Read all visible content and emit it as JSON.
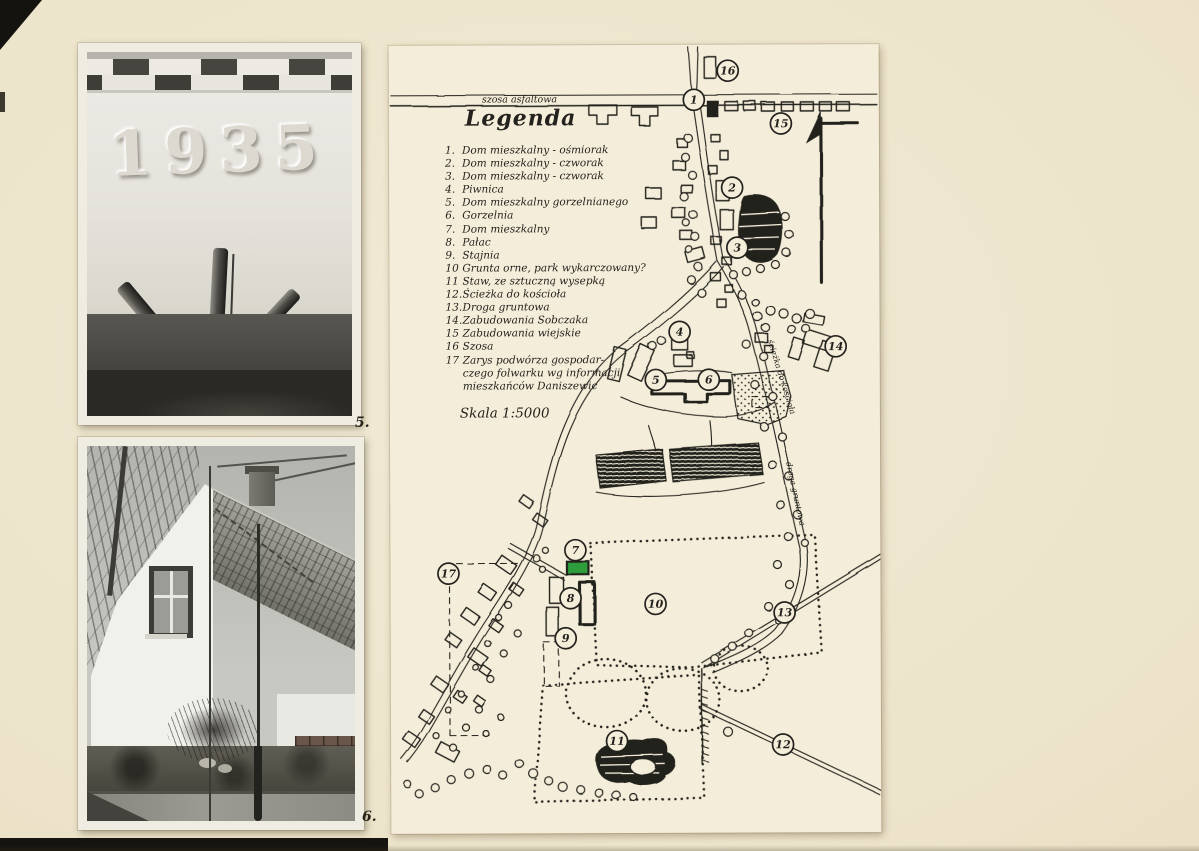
{
  "page": {
    "photo_labels": {
      "top_photo": "5.",
      "bottom_photo": "6."
    }
  },
  "photos": {
    "top": {
      "inscription": "1935"
    }
  },
  "map": {
    "ink_color": "#24221e",
    "highlight_color": "#2f9e3c",
    "legend": {
      "title": "Legenda",
      "items": [
        {
          "num": "1.",
          "label": "Dom mieszkalny - ośmiorak"
        },
        {
          "num": "2.",
          "label": "Dom mieszkalny - czworak"
        },
        {
          "num": "3.",
          "label": "Dom mieszkalny - czworak"
        },
        {
          "num": "4.",
          "label": "Piwnica"
        },
        {
          "num": "5.",
          "label": "Dom mieszkalny gorzelnianego"
        },
        {
          "num": "6.",
          "label": "Gorzelnia"
        },
        {
          "num": "7.",
          "label": "Dom mieszkalny"
        },
        {
          "num": "8.",
          "label": "Pałac"
        },
        {
          "num": "9.",
          "label": "Stajnia"
        },
        {
          "num": "10",
          "label": "Grunta orne, park wykarczowany?"
        },
        {
          "num": "11",
          "label": "Staw, ze sztuczną wysepką"
        },
        {
          "num": "12.",
          "label": "Ścieżka do kościoła"
        },
        {
          "num": "13.",
          "label": "Droga gruntowa"
        },
        {
          "num": "14.",
          "label": "Zabudowania Sobczaka"
        },
        {
          "num": "15",
          "label": "Zabudowania wiejskie"
        },
        {
          "num": "16",
          "label": "Szosa"
        },
        {
          "num": "17",
          "label": "Zarys podwórza gospodar-\nczego folwarku wg informacji\nmieszkańców Daniszewic"
        }
      ],
      "scale": "Skala 1:5000"
    },
    "road_labels": {
      "highway": "szosa asfaltowa",
      "church_path": "ścieżka do kościoła",
      "dirt_road": "droga gruntowa"
    },
    "markers": [
      {
        "n": "1",
        "x": 305,
        "y": 55
      },
      {
        "n": "2",
        "x": 343,
        "y": 143
      },
      {
        "n": "3",
        "x": 348,
        "y": 203
      },
      {
        "n": "4",
        "x": 290,
        "y": 287
      },
      {
        "n": "5",
        "x": 266,
        "y": 335
      },
      {
        "n": "6",
        "x": 319,
        "y": 335
      },
      {
        "n": "7",
        "x": 185,
        "y": 505
      },
      {
        "n": "8",
        "x": 180,
        "y": 553
      },
      {
        "n": "9",
        "x": 175,
        "y": 593
      },
      {
        "n": "10",
        "x": 265,
        "y": 559
      },
      {
        "n": "11",
        "x": 226,
        "y": 696
      },
      {
        "n": "12",
        "x": 392,
        "y": 700
      },
      {
        "n": "13",
        "x": 394,
        "y": 568
      },
      {
        "n": "14",
        "x": 446,
        "y": 302
      },
      {
        "n": "15",
        "x": 392,
        "y": 79
      },
      {
        "n": "16",
        "x": 339,
        "y": 26
      },
      {
        "n": "17",
        "x": 58,
        "y": 528
      }
    ]
  }
}
